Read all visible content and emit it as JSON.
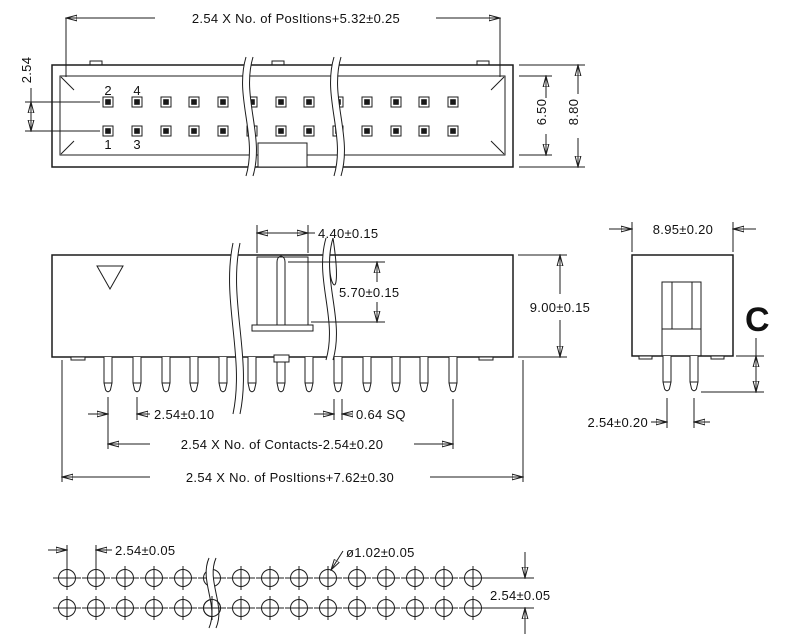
{
  "drawing": {
    "type": "connector-technical-drawing",
    "background": "#ffffff",
    "line_color": "#1c1c1c",
    "top_view": {
      "dim_total_width": "2.54 X No. of PosItions+5.32±0.25",
      "dim_row_pitch": "2.54",
      "dim_cavity_height": "6.50",
      "dim_body_height": "8.80",
      "pin_label_1": "1",
      "pin_label_2": "2",
      "pin_label_3": "3",
      "pin_label_4": "4",
      "pin_columns": 13,
      "pin_rows": 2
    },
    "front_view": {
      "dim_key_slot_width": "4.40±0.15",
      "dim_key_slot_depth": "5.70±0.15",
      "dim_body_height": "9.00±0.15",
      "dim_pin_pitch": "2.54±0.10",
      "dim_pin_square": "0.64 SQ",
      "dim_contacts_span": "2.54 X No. of Contacts-2.54±0.20",
      "dim_positions_span": "2.54 X No. of PosItions+7.62±0.30",
      "pin_count": 13
    },
    "side_view": {
      "dim_body_depth": "8.95±0.20",
      "dim_pin_row_pitch": "2.54±0.20",
      "pin_length_label": "C"
    },
    "footprint": {
      "dim_hole_pitch": "2.54±0.05",
      "dim_hole_diameter": "ø1.02±0.05",
      "dim_row_pitch": "2.54±0.05",
      "hole_columns": 15,
      "hole_rows": 2
    }
  }
}
